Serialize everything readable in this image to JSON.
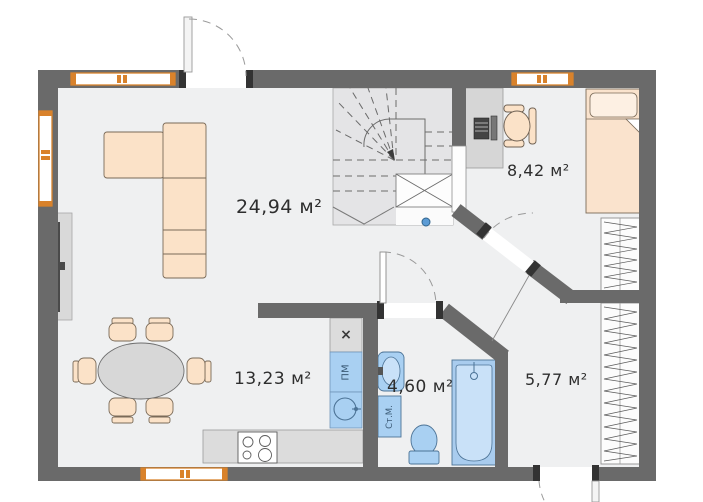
{
  "plan": {
    "title": "apartment-floor-plan",
    "rooms": [
      {
        "id": "living-room",
        "area_label": "24,94 м²"
      },
      {
        "id": "bedroom",
        "area_label": "8,42 м²"
      },
      {
        "id": "kitchen-dining",
        "area_label": "13,23 м²"
      },
      {
        "id": "bathroom",
        "area_label": "4,60 м²"
      },
      {
        "id": "hallway",
        "area_label": "5,77 м²"
      }
    ],
    "appliances": {
      "hob_box_label": "×",
      "dishwasher_label": "ПМ",
      "washing_machine_label": "Ст.М."
    },
    "colors": {
      "wall": "#6a6a6a",
      "floor": "#eff0f1",
      "stairs_floor": "#e4e4e6",
      "furniture_peach": "#fbe2c8",
      "furniture_gray": "#d9d9d9",
      "fixture_blue": "#a9d0f2",
      "fixture_blue_light": "#c9e1f8",
      "window_frame_orange": "#d9822b",
      "riser_dot_blue": "#5b9bd5"
    }
  }
}
